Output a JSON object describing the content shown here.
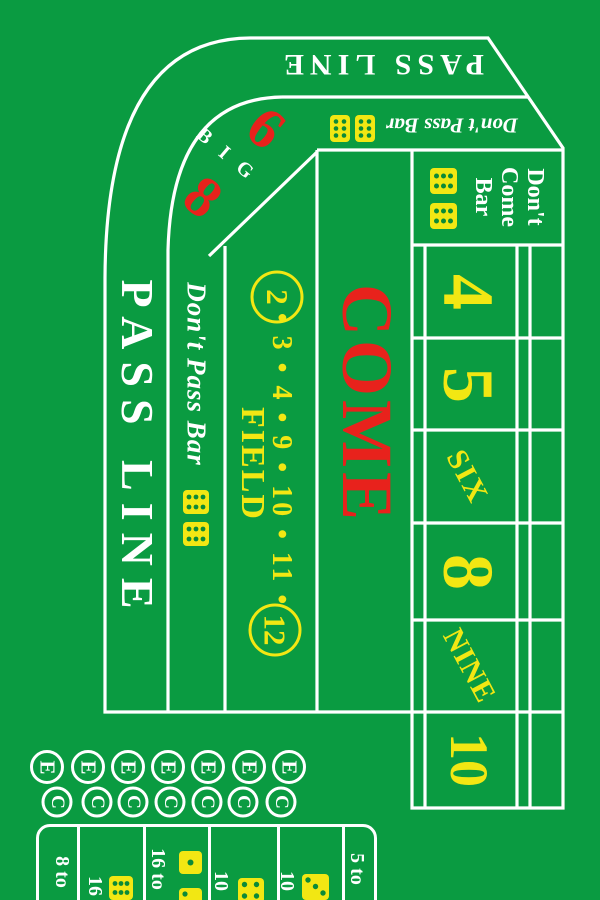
{
  "colors": {
    "felt": "#0a9b41",
    "line": "#ffffff",
    "yellow": "#f2e713",
    "red": "#e8221c",
    "dice": "#f2e713",
    "pip": "#0b8a38"
  },
  "table": {
    "pass_line_top": "PASS LINE",
    "pass_line_left": "PASS LINE",
    "dont_pass_bar_top": "Don't Pass Bar",
    "dont_pass_bar_left": "Don't Pass Bar",
    "big_6_8": {
      "label": "B I G",
      "six": "6",
      "eight": "8"
    },
    "field": {
      "label": "FIELD",
      "two": "2",
      "numbers": "• 3 • 4 • 9 • 10 • 11 •",
      "twelve": "12"
    },
    "come": "COME",
    "dont_come": {
      "line1": "Don't",
      "line2": "Come",
      "line3": "Bar"
    },
    "points": {
      "four": "4",
      "five": "5",
      "six": "SIX",
      "eight": "8",
      "nine": "NINE",
      "ten": "10"
    }
  },
  "one_roll": {
    "eleven": "E",
    "craps": "C"
  },
  "props": {
    "col1": "8 to",
    "col2": "16",
    "col3": "16 to",
    "col4": "10",
    "col5": "10",
    "col6": "5 to"
  }
}
